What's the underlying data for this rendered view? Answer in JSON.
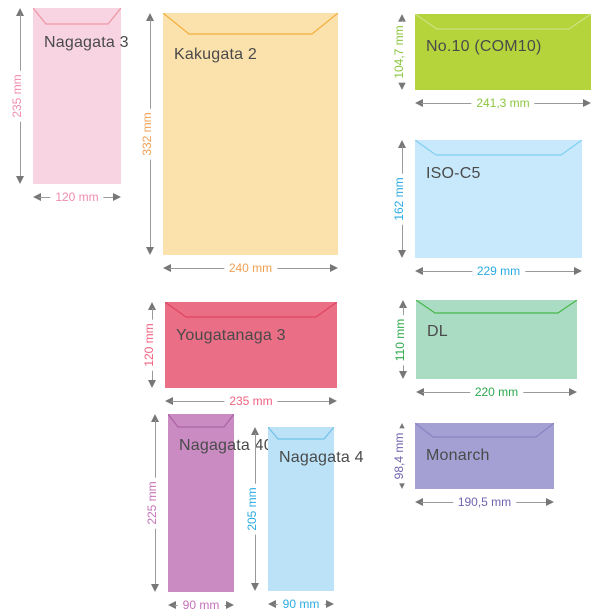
{
  "diagram": {
    "subject": "envelope-size-comparison",
    "unit": "mm",
    "arrow_line_color": "#9a9a9a",
    "arrow_head_color": "#777777",
    "name_color": "#4a4a4a",
    "background_color": "#ffffff",
    "envelopes": [
      {
        "name": "Nagagata 3",
        "width_label": "120 mm",
        "height_label": "235 mm",
        "fill": "#f8d3e2",
        "flap_stroke": "#ed97a3",
        "accent": "#f08cb0",
        "layout": {
          "x": 33,
          "y": 8,
          "w": 88,
          "h": 176,
          "flap_depth": 16,
          "flap_inset": 13,
          "label_top": 26
        }
      },
      {
        "name": "Kakugata 2",
        "width_label": "240 mm",
        "height_label": "332 mm",
        "fill": "#fbe2ad",
        "flap_stroke": "#f3ae3d",
        "accent": "#f0a055",
        "layout": {
          "x": 163,
          "y": 13,
          "w": 175,
          "h": 242,
          "flap_depth": 21,
          "flap_inset": 26,
          "label_top": 33
        }
      },
      {
        "name": "No.10 (COM10)",
        "width_label": "241,3 mm",
        "height_label": "104,7 mm",
        "fill": "#b5d43c",
        "flap_stroke": "#c8e47f",
        "accent": "#8cc63f",
        "layout": {
          "x": 415,
          "y": 14,
          "w": 176,
          "h": 76,
          "flap_depth": 15,
          "flap_inset": 22,
          "label_top": 24
        }
      },
      {
        "name": "ISO-C5",
        "width_label": "229 mm",
        "height_label": "162 mm",
        "fill": "#c8e9fb",
        "flap_stroke": "#7fcff3",
        "accent": "#2babe2",
        "layout": {
          "x": 415,
          "y": 140,
          "w": 167,
          "h": 118,
          "flap_depth": 15,
          "flap_inset": 21,
          "label_top": 25
        }
      },
      {
        "name": "Yougatanaga 3",
        "width_label": "235 mm",
        "height_label": "120 mm",
        "fill": "#ea6e85",
        "flap_stroke": "#e04663",
        "accent": "#f0627f",
        "layout": {
          "x": 165,
          "y": 302,
          "w": 172,
          "h": 86,
          "flap_depth": 15,
          "flap_inset": 21,
          "label_top": 25
        }
      },
      {
        "name": "DL",
        "width_label": "220 mm",
        "height_label": "110 mm",
        "fill": "#aadcc4",
        "flap_stroke": "#48b748",
        "accent": "#2ea94f",
        "layout": {
          "x": 416,
          "y": 300,
          "w": 161,
          "h": 79,
          "flap_depth": 13,
          "flap_inset": 19,
          "label_top": 23
        }
      },
      {
        "name": "Nagagata 40",
        "width_label": "90 mm",
        "height_label": "225 mm",
        "fill": "#c98bc2",
        "flap_stroke": "#ac62a4",
        "accent": "#c472b8",
        "layout": {
          "x": 168,
          "y": 414,
          "w": 66,
          "h": 178,
          "flap_depth": 13,
          "flap_inset": 10,
          "label_top": 23
        }
      },
      {
        "name": "Nagagata 4",
        "width_label": "90 mm",
        "height_label": "205 mm",
        "fill": "#bce2f8",
        "flap_stroke": "#6fc1e7",
        "accent": "#2babe2",
        "layout": {
          "x": 268,
          "y": 427,
          "w": 66,
          "h": 164,
          "flap_depth": 12,
          "flap_inset": 10,
          "label_top": 22
        }
      },
      {
        "name": "Monarch",
        "width_label": "190,5 mm",
        "height_label": "98,4 mm",
        "fill": "#a5a0d3",
        "flap_stroke": "#8b82c2",
        "accent": "#6f64ae",
        "layout": {
          "x": 415,
          "y": 423,
          "w": 139,
          "h": 66,
          "flap_depth": 14,
          "flap_inset": 18,
          "label_top": 24
        }
      }
    ]
  }
}
